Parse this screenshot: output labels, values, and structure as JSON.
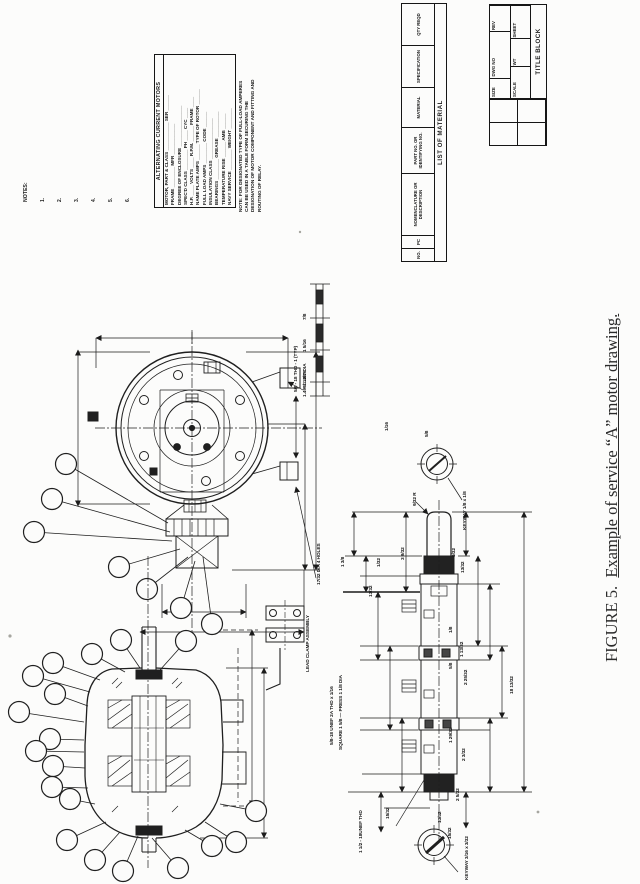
{
  "caption": {
    "prefix": "FIGURE 5.",
    "text": "Example of service “A” motor drawing."
  },
  "notes": {
    "title": "NOTES:",
    "items": [
      "1.",
      "2.",
      "3.",
      "4.",
      "5.",
      "6."
    ]
  },
  "motor_table": {
    "title": "ALTERNATING CURRENT MOTORS",
    "rows": [
      "MOTOR, PART & CLASS ___________  SER ______",
      "FRAME ________  MFR ____________",
      "DEGREE OF ENCLOSURE ________________",
      "SPEC'D CLASS ________  PH ____  CYC ____",
      "H.P. ____  VOLTS ____  R.P.M. ______  FRAME ____",
      "NAME PLATE  AMPS ______  TYPE OF ROTOR ______",
      "FULL LOAD AMPS ________  CODE ______",
      "INSULATION CLASS ________________",
      "BEARINGS ________  GREASE __________",
      "TEMPERATURE RISE ______  AMB ______",
      "NAVY SERVICE ________  WEIGHT ________"
    ]
  },
  "side_note": {
    "lines": [
      "NOTE:  FOR DESIGNATED TYPE OF FULL-LOAD AMPERES",
      "CAN BE USED IN A TABLE FORM SECURING THE",
      "DESIGNATION OF MOTOR COMPONENT AND FITTING AND",
      "ROUTING OF RELAY."
    ]
  },
  "list_of_material": {
    "title": "LIST OF MATERIAL",
    "columns": [
      "NO.",
      "PC",
      "NOMENCLATURE OR DESCRIPTION",
      "PART NO. OR IDENTIFYING NO.",
      "MATERIAL",
      "SPECIFICATION",
      "QTY REQD"
    ]
  },
  "title_block": {
    "title": "TITLE BLOCK",
    "cells": [
      "SIZE",
      "DWG NO",
      "REV",
      "SCALE",
      "WT",
      "SHEET"
    ]
  },
  "mini_table": {
    "label": "5/8 - 18 THD - 1 (TYP)",
    "items": [
      "7/8",
      "1 5/16",
      "1 13/16"
    ]
  },
  "details": {
    "lead_clamp": "LEAD CLAMP ASSEMBLY",
    "dia_top": "1.499/1.497 DIA",
    "mtg_holes": "17/32 DIA 4 HOLES",
    "keyway_top": "KEYWAY 1/8 x 1/8",
    "keyway_bottom": "KEYWAY 3/16 x 3/32",
    "thread_bottom": "1 1/2 - 18UNEF THD",
    "thread_left_1": "5/8-18 UNEF 2A THD x 1/16",
    "thread_left_2": "SQUARE 1 5/8 — PRESS 1 1/8 DIA"
  },
  "dims": [
    "3 9/32",
    "9/32 R",
    "1/32",
    "1 3/8",
    "13/32",
    "9/32",
    "13/32",
    "1/8",
    "1 13/32",
    "5/8",
    "2 25/32",
    "1 29/32",
    "2 3/32",
    "15/32",
    "13/32",
    "15/32",
    "2 5/32",
    "18 13/32",
    "1/16",
    "5/8"
  ]
}
